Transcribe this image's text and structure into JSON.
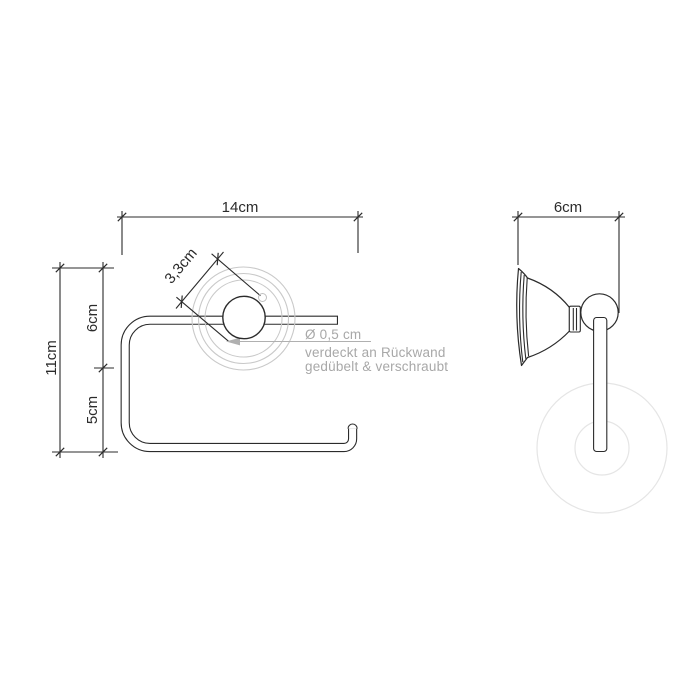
{
  "colors": {
    "line": "#2b2b2b",
    "annotation_gray": "#a8a8a8",
    "ghost_ring_gray": "#c9c9c9",
    "ghost_roll_gray": "#e5e5e5",
    "background": "#ffffff"
  },
  "front_view": {
    "dim_width": "14cm",
    "dim_height_total": "11cm",
    "dim_height_upper": "6cm",
    "dim_height_lower": "5cm",
    "dim_rosette": "3,3cm"
  },
  "side_view": {
    "dim_depth": "6cm"
  },
  "annotation": {
    "screw_diameter": "Ø 0,5 cm",
    "note_line1": "verdeckt an Rückwand",
    "note_line2": "gedübelt & verschraubt"
  }
}
